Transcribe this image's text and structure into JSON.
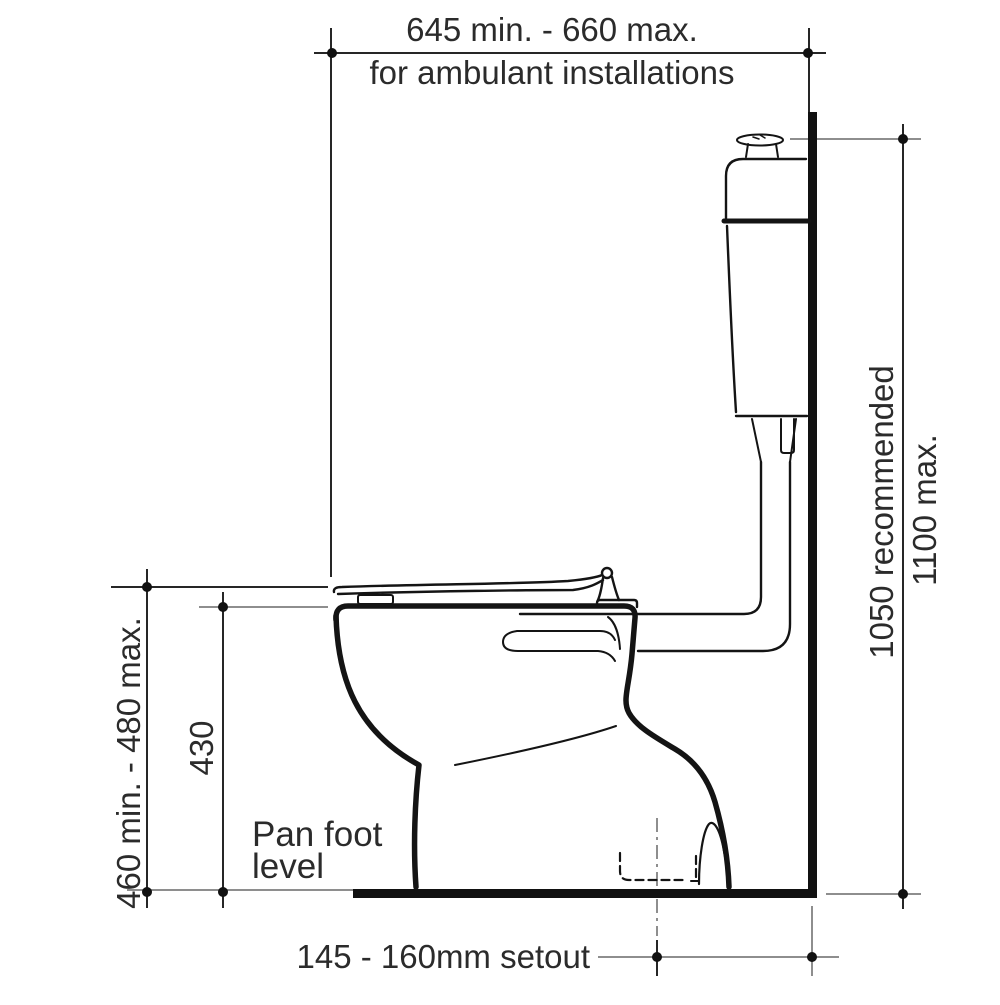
{
  "diagram": {
    "type": "toilet-suite-installation-drawing",
    "dimensions": {
      "top": {
        "value": "645 min. - 660 max.",
        "note": "for ambulant installations"
      },
      "right": {
        "recommended": "1050 recommended",
        "max": "1100 max."
      },
      "left": {
        "seat_height": "460 min. - 480 max.",
        "pan_height": "430"
      },
      "bottom": {
        "setout": "145 - 160mm setout"
      }
    },
    "annotations": {
      "pan_foot_line1": "Pan foot",
      "pan_foot_line2": "level"
    },
    "colors": {
      "drawing_line": "#141414",
      "dimension_line": "#262626",
      "leader_line": "#8e8e8e",
      "text": "#2b2b2b",
      "background": "#ffffff"
    }
  }
}
